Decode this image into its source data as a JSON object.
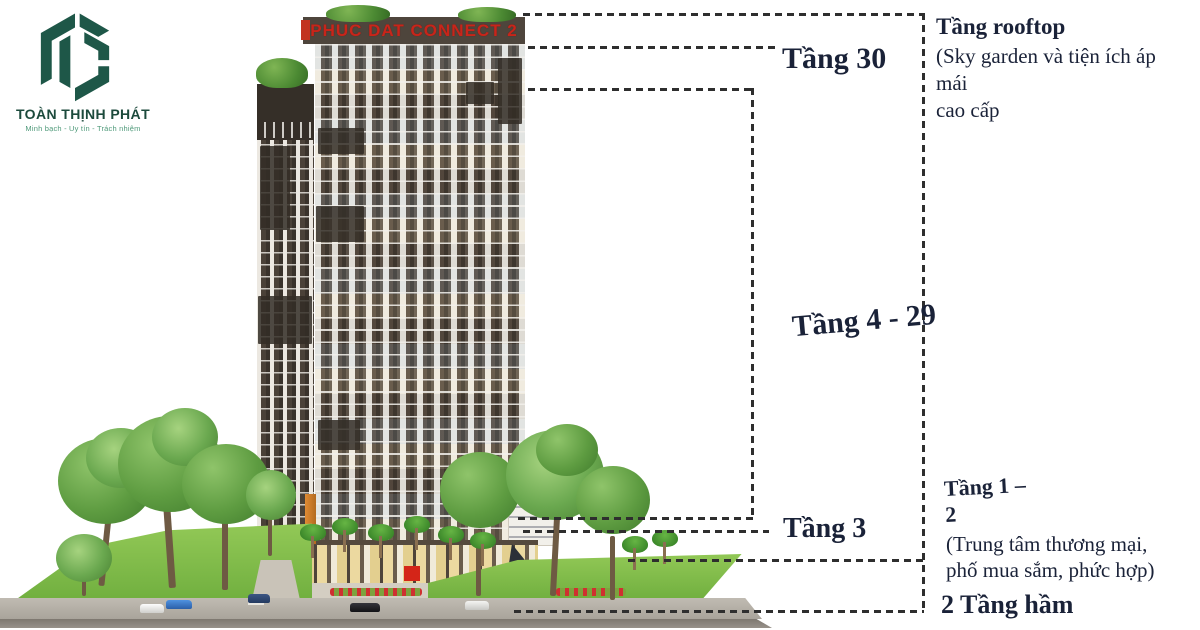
{
  "logo": {
    "company": "TOÀN THỊNH PHÁT",
    "tagline": "Minh bạch - Uy tín - Trách nhiệm"
  },
  "building": {
    "sign": "PHUC DAT CONNECT 2"
  },
  "labels": {
    "floor30": "Tầng 30",
    "floor4_29": "Tầng 4 - 29",
    "floor3": "Tầng 3"
  },
  "callouts": {
    "rooftop": {
      "title": "Tầng rooftop",
      "line1": "(Sky garden và tiện ích áp mái",
      "line2": "cao cấp"
    },
    "floor1_2": {
      "title": "Tầng 1 – 2",
      "line1": "(Trung tâm thương mại,",
      "line2": "phố mua sắm, phức hợp)"
    },
    "basement": {
      "title": "2 Tầng hầm"
    }
  },
  "colors": {
    "brand_green": "#1e5748",
    "label_navy": "#1a2238",
    "sign_red": "#c8251a",
    "lawn_green": "#7ab648"
  }
}
